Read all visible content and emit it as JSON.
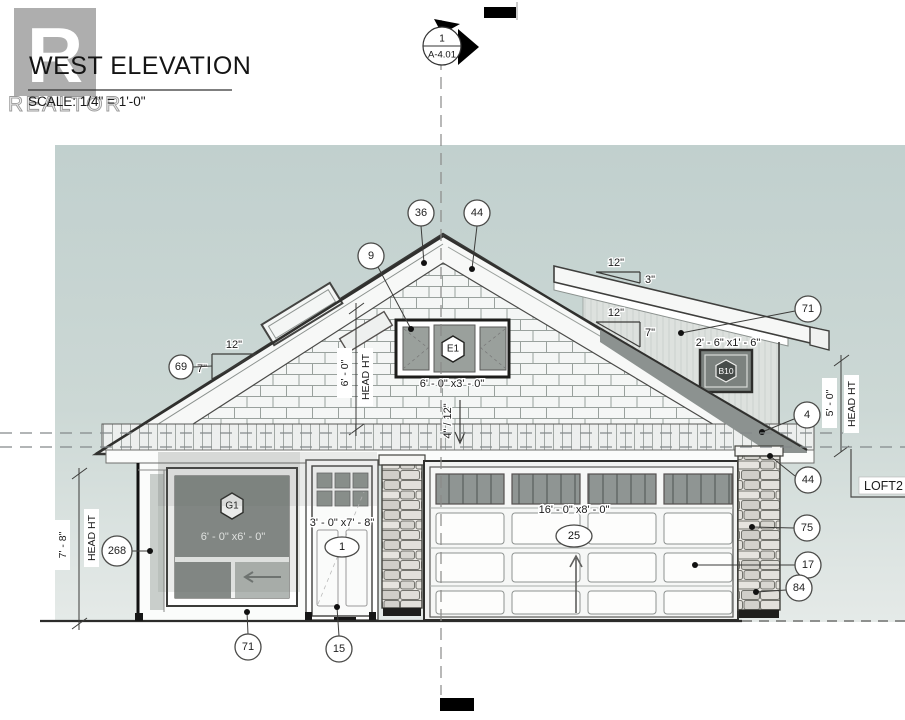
{
  "t": {
    "title": "WEST ELEVATION",
    "scale": "SCALE:   1/4\" = 1'-0\"",
    "wm_letter": "R",
    "wm_word": "REALTOR",
    "marker_top": "1",
    "marker_bottom": "A-4.01",
    "loft": "LOFT2"
  },
  "slopes": {
    "left": {
      "run": "12\"",
      "rise": "7\""
    },
    "loft": {
      "run": "12\"",
      "rise": "3\""
    },
    "right": {
      "run": "12\"",
      "rise": "7\""
    },
    "center": "4\" / 12\""
  },
  "tags": {
    "e1": "E1",
    "b10": "B10",
    "g1": "G1",
    "door": "1",
    "garage": "25"
  },
  "dims": {
    "e1": "6' - 0\" x3' - 0\"",
    "b10": "2' - 6\" x1' - 6\"",
    "g1": "6' - 0\" x6' - 0\"",
    "door": "3' - 0\" x7' - 8\"",
    "garage": "16' - 0\" x8' - 0\"",
    "head_left": {
      "value": "7' - 8\"",
      "label": "HEAD HT"
    },
    "head_mid": {
      "value": "6' - 0\"",
      "label": "HEAD HT"
    },
    "head_right": {
      "value": "5' - 0\"",
      "label": "HEAD HT"
    }
  },
  "callouts": [
    "36",
    "44",
    "9",
    "69",
    "71",
    "4",
    "44",
    "268",
    "75",
    "17",
    "84",
    "71",
    "15"
  ],
  "colors": {
    "sky": "#c2d1cf",
    "line": "#3a3d3b",
    "shadow": "#8c9290",
    "glass": "#9aa09c"
  }
}
